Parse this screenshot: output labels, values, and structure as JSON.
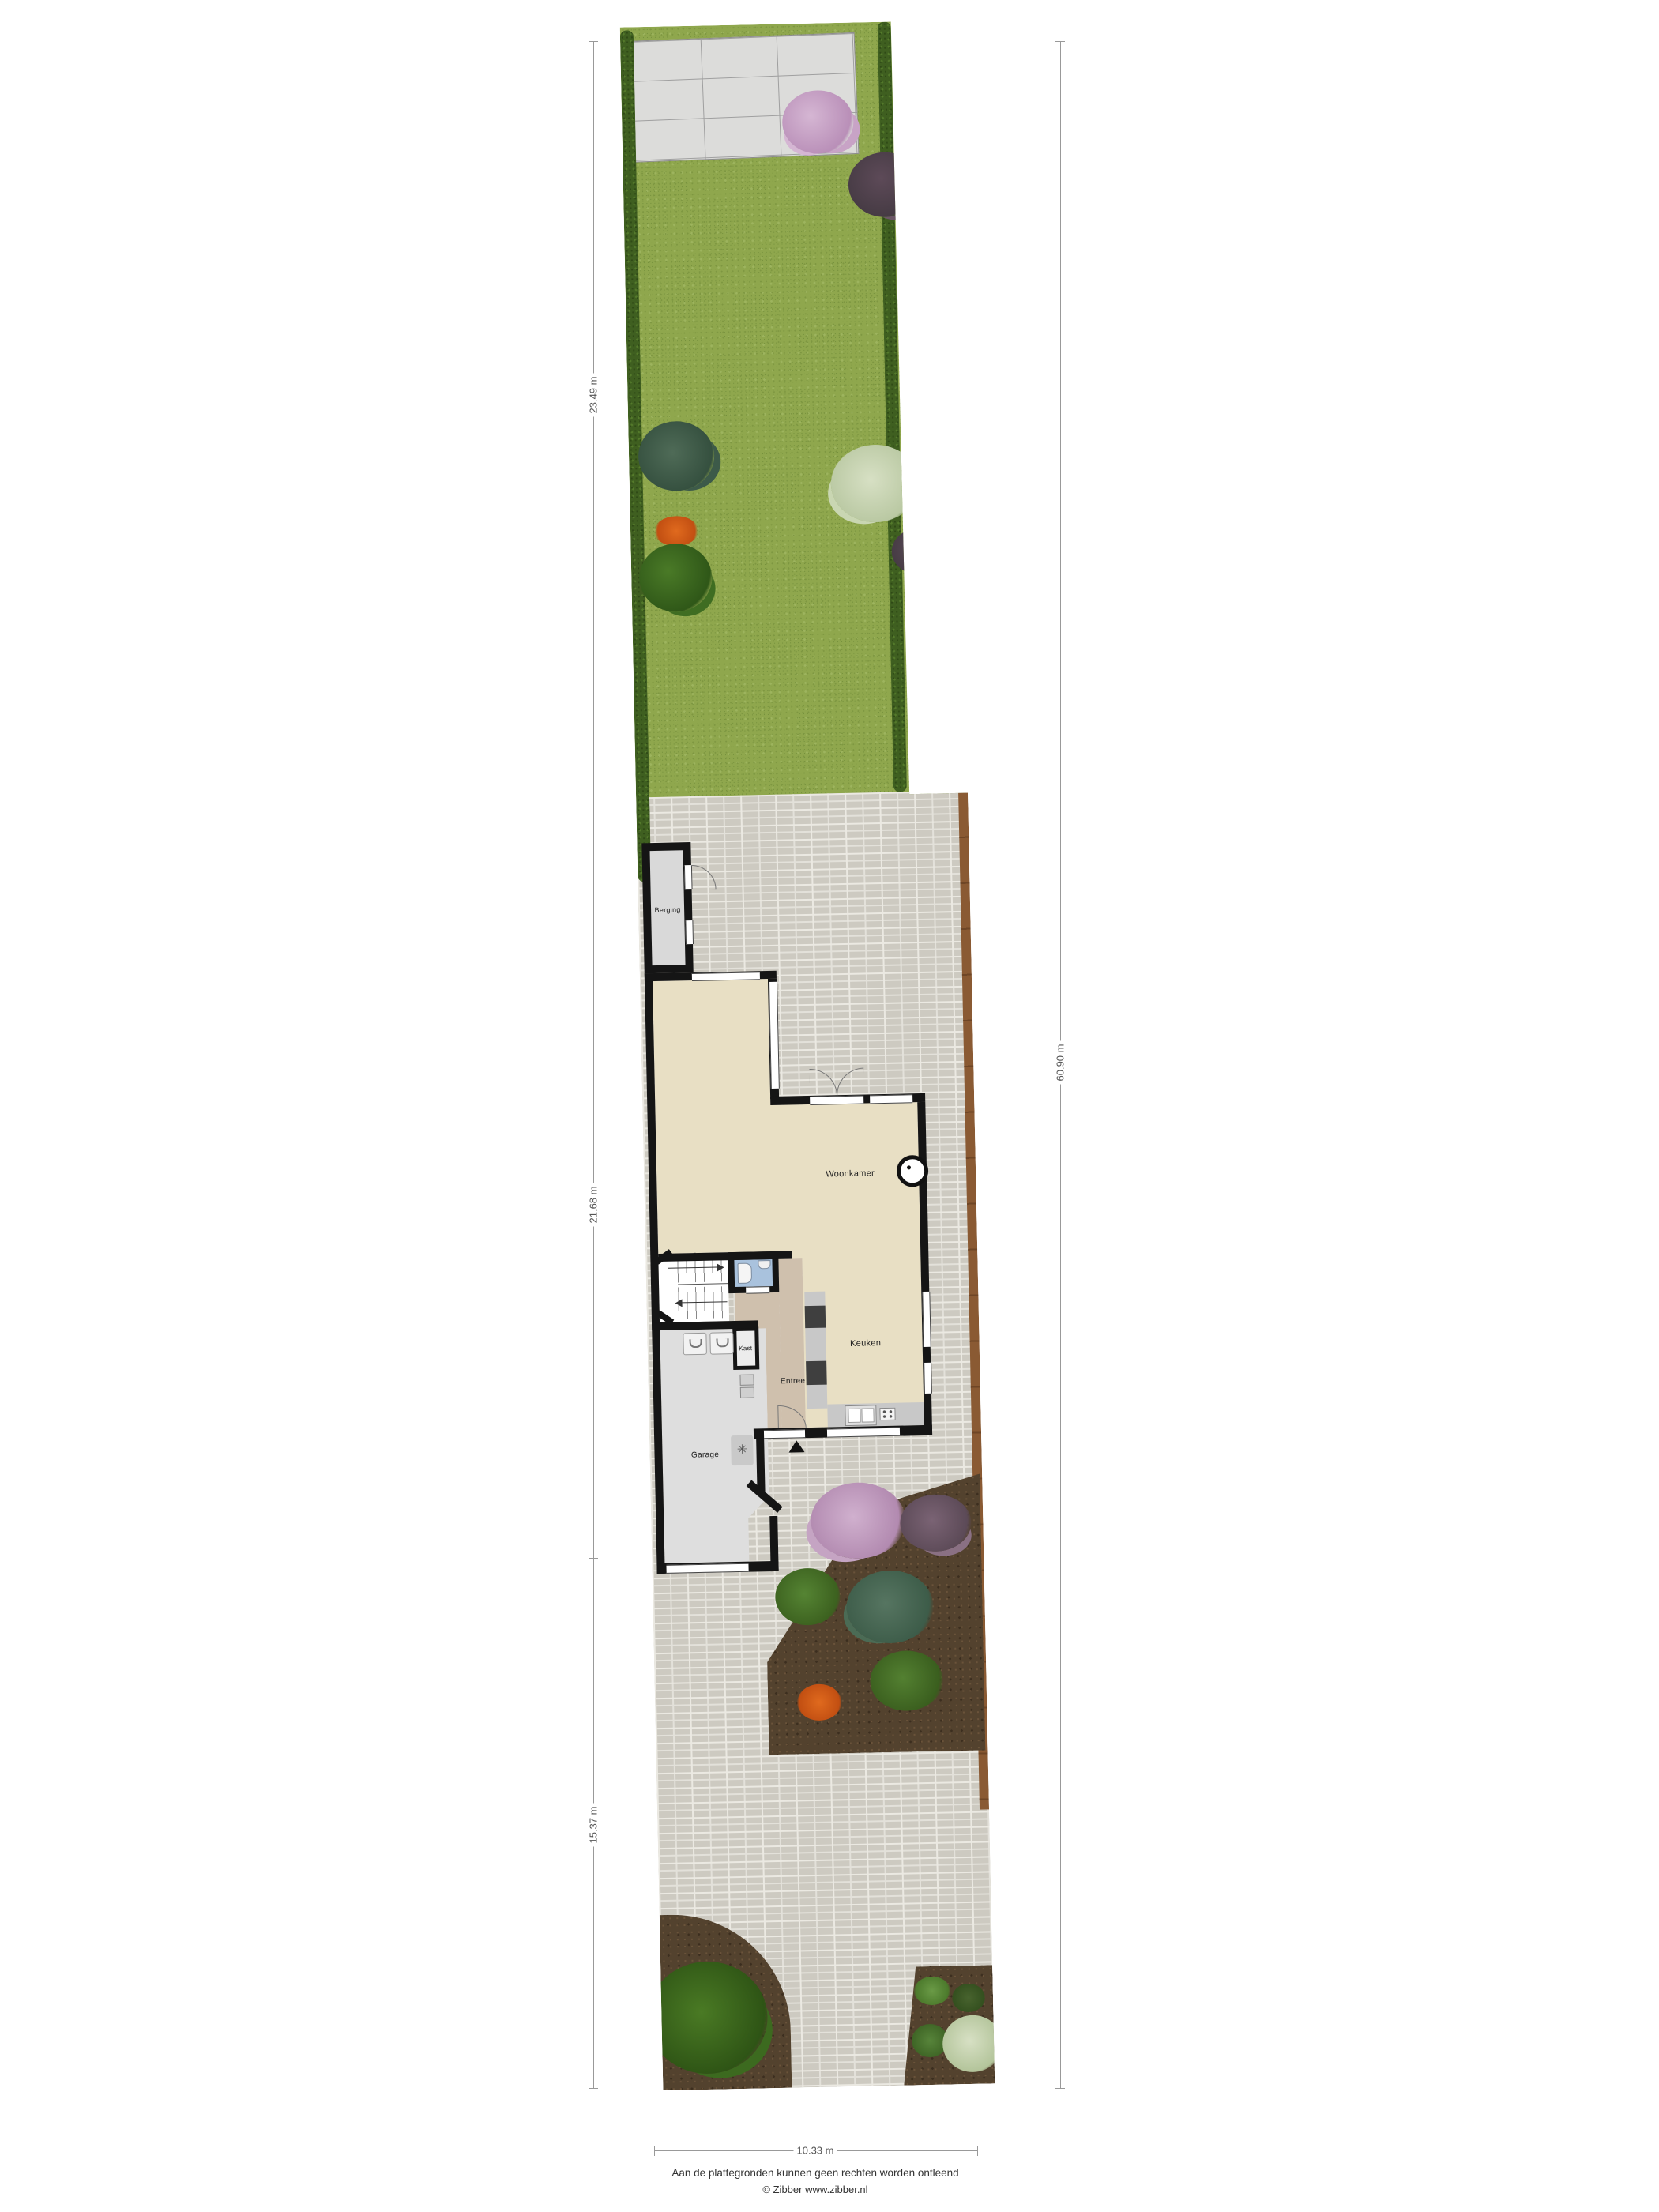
{
  "rooms": {
    "berging": "Berging",
    "woonkamer": "Woonkamer",
    "keuken": "Keuken",
    "entree": "Entree",
    "kast": "Kast",
    "garage": "Garage"
  },
  "dimensions": {
    "garden_depth": "23.49 m",
    "house_depth": "21.68 m",
    "front_depth": "15.37 m",
    "total_depth": "60.90 m",
    "plot_width": "10.33 m"
  },
  "footer": {
    "disclaimer": "Aan de plattegronden kunnen geen rechten worden ontleend",
    "copyright": "© Zibber www.zibber.nl"
  },
  "icons": {
    "ventilation_unit": "✳"
  },
  "colors": {
    "grass": "#8fa74d",
    "hedge": "#3f5f20",
    "brick_paving": "#cdcac1",
    "terrace_slab": "#dcdcda",
    "soil_bed": "#53422e",
    "wall": "#151515",
    "living_floor": "#e8dfc4",
    "hall_floor": "#cfc0ad",
    "toilet_floor": "#a9c2dd",
    "garage_floor": "#dedede",
    "fence": "#8a5a33"
  }
}
